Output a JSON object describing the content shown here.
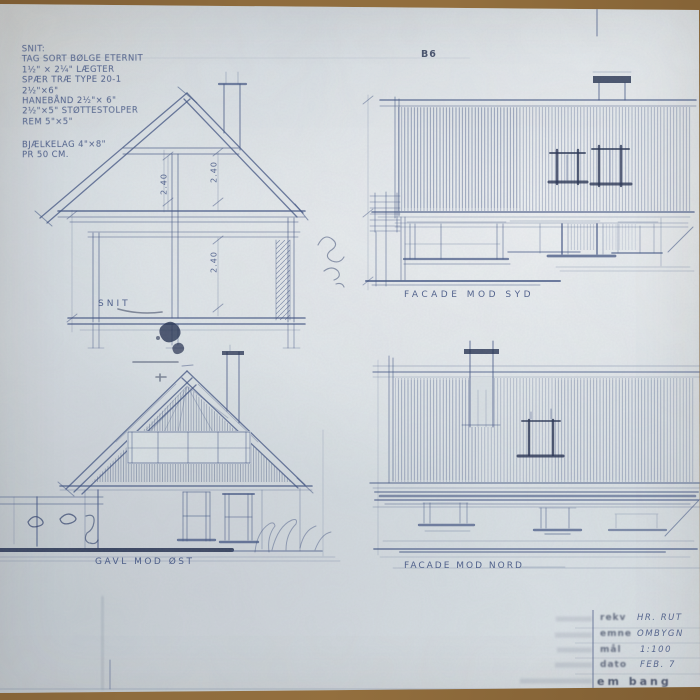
{
  "colors": {
    "wood": "#8c6b3e",
    "paper": "#d9dfe3",
    "pencil": "#3d507f",
    "ink": "#1e2a4a"
  },
  "spec": {
    "lines": [
      "SNIT:",
      "TAG SORT BØLGE ETERNIT",
      "1½\" × 2¼\" LÆGTER",
      "SPÆR TRÆ TYPE 20-1",
      "2½\"×6\"",
      "HANEBÅND 2½\"× 6\"",
      "2½\"×5\" STØTTESTOLPER",
      "REM 5\"×5\""
    ],
    "type_mark": "B6",
    "footer": [
      "BJÆLKELAG 4\"×8\"",
      "PR 50 CM."
    ]
  },
  "drawings": {
    "snit": {
      "label": "SNIT",
      "dim_attic_left": "2.40",
      "dim_attic_right": "2.40",
      "dim_ground": "2.40"
    },
    "facade_syd": {
      "label": "FACADE MOD SYD"
    },
    "gavl_ost": {
      "label": "GAVL MOD ØST"
    },
    "facade_nord": {
      "label": "FACADE MOD NORD"
    }
  },
  "title_block": {
    "rows": [
      {
        "label": "rekv",
        "value": "HR. RUT"
      },
      {
        "label": "emne",
        "value": "OMBYGN"
      },
      {
        "label": "mål",
        "value": "1:100"
      },
      {
        "label": "dato",
        "value": "FEB. 7"
      }
    ],
    "stamp": "em bang"
  }
}
